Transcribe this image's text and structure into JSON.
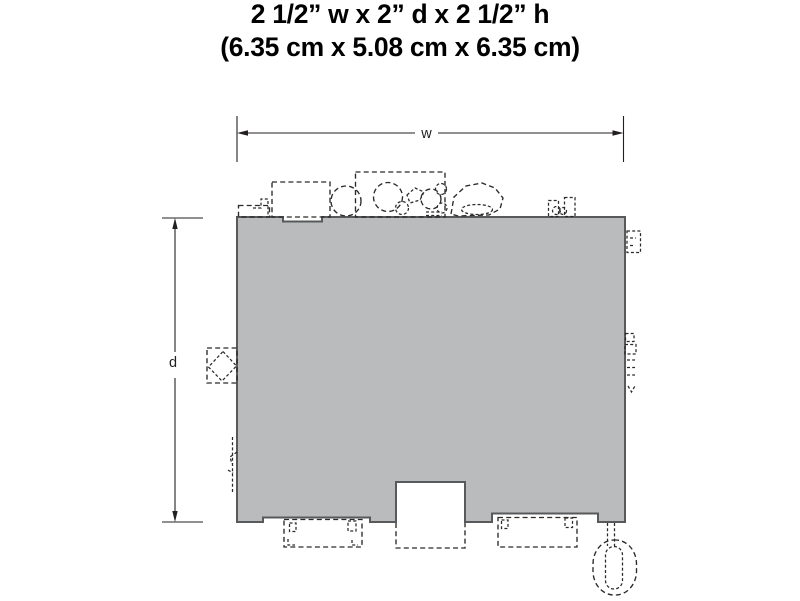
{
  "figure": {
    "title_line1": "2 1/2” w x 2” d x 2 1/2” h",
    "title_line2": "(6.35 cm x 5.08 cm x 6.35 cm)"
  },
  "dimension_labels": {
    "width": "w",
    "depth": "d"
  },
  "colors": {
    "background": "#ffffff",
    "title_text": "#000000",
    "footprint_fill": "#b9bbbd",
    "footprint_outline": "#58595b",
    "detail_line": "#2b2a29",
    "dimension_line": "#231f20"
  }
}
